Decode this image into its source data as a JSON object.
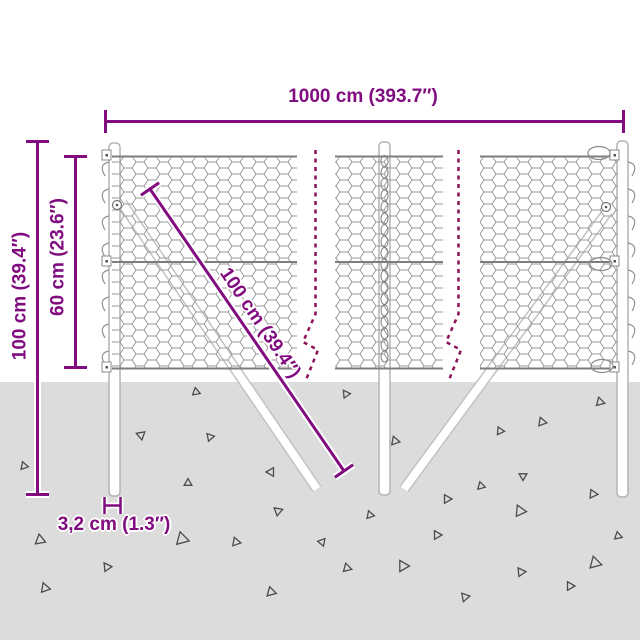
{
  "diagram": {
    "type": "product-dimension-diagram",
    "subject": "wire mesh fence with posts and braces"
  },
  "dimensions": {
    "total_width": "1000 cm (393.7″)",
    "total_height": "100 cm (39.4″)",
    "mesh_height": "60 cm (23.6″)",
    "brace_length": "100 cm (39.4″)",
    "post_thickness": "3,2 cm (1.3″)"
  },
  "colors": {
    "background": "#ffffff",
    "dimension_purple": "#800c80",
    "break_dash_magenta": "#8c1257",
    "ground_gray": "#dcdcdc",
    "mesh_wire_gray": "#9a9a9a",
    "post_outline_gray": "#b3b3b3",
    "triangle_outline": "#4b4b4b"
  },
  "ground": {
    "top_y": 382,
    "triangles": [
      [
        196,
        392,
        4.5,
        260
      ],
      [
        346,
        394,
        4.5,
        355
      ],
      [
        600,
        402,
        5,
        15
      ],
      [
        542,
        422,
        5,
        10
      ],
      [
        141,
        435,
        5,
        200
      ],
      [
        210,
        437,
        4.5,
        350
      ],
      [
        500,
        431,
        4.5,
        245
      ],
      [
        395,
        441,
        5,
        250
      ],
      [
        24,
        466,
        4.5,
        250
      ],
      [
        271,
        472,
        5,
        180
      ],
      [
        188,
        483,
        4.5,
        150
      ],
      [
        481,
        486,
        4.5,
        255
      ],
      [
        523,
        476,
        4.5,
        210
      ],
      [
        447,
        499,
        5,
        240
      ],
      [
        593,
        494,
        5,
        245
      ],
      [
        278,
        511,
        5,
        100
      ],
      [
        520,
        511,
        6.5,
        5
      ],
      [
        370,
        515,
        4.5,
        250
      ],
      [
        40,
        540,
        6,
        260
      ],
      [
        182,
        539,
        7.5,
        255
      ],
      [
        236,
        542,
        5,
        250
      ],
      [
        437,
        535,
        5,
        240
      ],
      [
        322,
        542,
        4.5,
        190
      ],
      [
        618,
        536,
        4.5,
        20
      ],
      [
        45,
        588,
        5.5,
        250
      ],
      [
        107,
        567,
        5,
        235
      ],
      [
        271,
        592,
        5.5,
        255
      ],
      [
        347,
        568,
        5,
        255
      ],
      [
        403,
        566,
        6.5,
        240
      ],
      [
        465,
        597,
        5,
        230
      ],
      [
        521,
        572,
        5,
        235
      ],
      [
        570,
        586,
        5,
        240
      ],
      [
        595,
        563,
        7,
        15
      ]
    ]
  }
}
